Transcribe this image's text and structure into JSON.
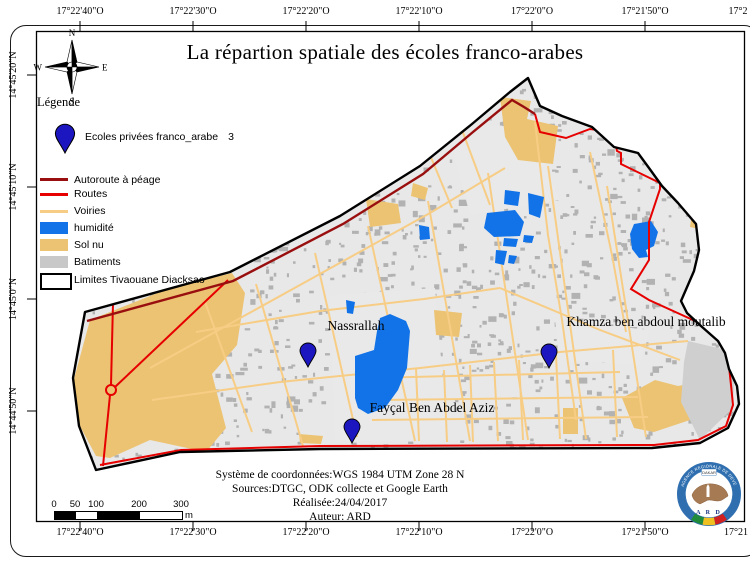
{
  "title": "La répartion spatiale des écoles franco-arabes",
  "compass": {
    "n": "N",
    "e": "E",
    "s": "S",
    "w": "W"
  },
  "legend": {
    "heading": "Légende",
    "schools": {
      "label": "Ecoles privées franco_arabe",
      "count": "3"
    },
    "items": [
      {
        "label": "Autoroute à péage",
        "swatch": "line",
        "color": "#990f0f",
        "y": 178,
        "h": 3
      },
      {
        "label": "Routes",
        "swatch": "line",
        "color": "#e60000",
        "y": 193,
        "h": 2.5
      },
      {
        "label": "Voiries",
        "swatch": "line",
        "color": "#f7cd85",
        "y": 210,
        "h": 2.5
      },
      {
        "label": "humidité",
        "swatch": "rect",
        "color": "#1273e8",
        "y": 222,
        "h": 12
      },
      {
        "label": "Sol nu",
        "swatch": "rect",
        "color": "#ecc372",
        "y": 239,
        "h": 12
      },
      {
        "label": "Batiments",
        "swatch": "rect",
        "color": "#c8c8c8",
        "y": 256,
        "h": 12
      },
      {
        "label": "Limites Tivaouane Diacksao",
        "swatch": "outline",
        "color": "#ffffff",
        "y": 273,
        "h": 13
      }
    ]
  },
  "graticule": {
    "top": [
      {
        "text": "17°22'40\"O",
        "x": 80
      },
      {
        "text": "17°22'30\"O",
        "x": 193
      },
      {
        "text": "17°22'20\"O",
        "x": 306
      },
      {
        "text": "17°22'10\"O",
        "x": 419
      },
      {
        "text": "17°22'0\"O",
        "x": 532
      },
      {
        "text": "17°21'50\"O",
        "x": 645
      },
      {
        "text": "17°2",
        "x": 738,
        "partial": true
      }
    ],
    "bottom": [
      {
        "text": "17°22'40\"O",
        "x": 80
      },
      {
        "text": "17°22'30\"O",
        "x": 193
      },
      {
        "text": "17°22'20\"O",
        "x": 306
      },
      {
        "text": "17°22'10\"O",
        "x": 419
      },
      {
        "text": "17°22'0\"O",
        "x": 532
      },
      {
        "text": "17°21'50\"O",
        "x": 645
      },
      {
        "text": "17°21",
        "x": 736,
        "partial": true
      }
    ],
    "left": [
      {
        "text": "14°45'20\"N",
        "y": 75
      },
      {
        "text": "14°45'10\"N",
        "y": 187
      },
      {
        "text": "14°45'0\"N",
        "y": 299
      },
      {
        "text": "14°44'50\"N",
        "y": 411
      }
    ]
  },
  "map_labels": [
    {
      "text": "Nassrallah",
      "x": 356,
      "y": 330
    },
    {
      "text": "Fayçal Ben Abdel Aziz",
      "x": 432,
      "y": 412
    },
    {
      "text": "Khamza ben abdoul moutalib",
      "x": 646,
      "y": 326
    }
  ],
  "credits": [
    "Système de coordonnées:WGS 1984 UTM Zone 28 N",
    "Sources:DTGC, ODK collecte et Google Earth",
    "Réalisée:24/04/2017",
    "Auteur: ARD"
  ],
  "scalebar": {
    "labels": [
      {
        "t": "0",
        "o": 0
      },
      {
        "t": "50",
        "o": 21
      },
      {
        "t": "100",
        "o": 42
      },
      {
        "t": "200",
        "o": 85
      },
      {
        "t": "300",
        "o": 127
      }
    ],
    "segments": [
      {
        "o": 0,
        "w": 21,
        "c": "#000000"
      },
      {
        "o": 21,
        "w": 21,
        "c": "#ffffff"
      },
      {
        "o": 42,
        "w": 43,
        "c": "#000000"
      },
      {
        "o": 85,
        "w": 42,
        "c": "#ffffff"
      }
    ],
    "unit": "m"
  },
  "logo": {
    "ring_text": "AGENCE REGIONALE DE DEVELOPPEMENT",
    "banner": "DAKAR",
    "name": "A R D"
  },
  "colors": {
    "district_bg": "#e8e8e8",
    "building": "#b2b2b2",
    "clearing": "#e9e9e9",
    "sol_nu": "#ecc372",
    "voirie": "#f7cd85",
    "humidite": "#1273e8",
    "autoroute": "#990f0f",
    "route": "#e60000",
    "boundary": "#000000",
    "pin": "#1c16c0",
    "batiment_zone": "#cfcfcf"
  },
  "map": {
    "boundary": [
      [
        85,
        312
      ],
      [
        230,
        272
      ],
      [
        340,
        216
      ],
      [
        420,
        166
      ],
      [
        472,
        124
      ],
      [
        510,
        92
      ],
      [
        528,
        78
      ],
      [
        540,
        106
      ],
      [
        562,
        116
      ],
      [
        592,
        127
      ],
      [
        614,
        147
      ],
      [
        638,
        153
      ],
      [
        649,
        168
      ],
      [
        662,
        186
      ],
      [
        678,
        203
      ],
      [
        696,
        224
      ],
      [
        699,
        250
      ],
      [
        694,
        271
      ],
      [
        681,
        301
      ],
      [
        687,
        313
      ],
      [
        701,
        326
      ],
      [
        718,
        341
      ],
      [
        725,
        353
      ],
      [
        729,
        369
      ],
      [
        737,
        386
      ],
      [
        739,
        404
      ],
      [
        728,
        428
      ],
      [
        700,
        443
      ],
      [
        652,
        448
      ],
      [
        320,
        449
      ],
      [
        180,
        452
      ],
      [
        96,
        470
      ],
      [
        79,
        426
      ],
      [
        73,
        378
      ]
    ],
    "autoroute": [
      [
        87,
        321
      ],
      [
        233,
        281
      ],
      [
        343,
        224
      ],
      [
        423,
        174
      ],
      [
        473,
        132
      ],
      [
        512,
        100
      ],
      [
        524,
        107
      ],
      [
        535,
        114
      ]
    ],
    "routes": [
      [
        [
          535,
          114
        ],
        [
          540,
          132
        ],
        [
          566,
          138
        ],
        [
          590,
          129
        ],
        [
          613,
          132
        ],
        [
          617,
          151
        ],
        [
          621,
          153
        ],
        [
          621,
          164
        ],
        [
          660,
          183
        ],
        [
          660,
          189
        ],
        [
          649,
          222
        ],
        [
          649,
          260
        ],
        [
          631,
          289
        ],
        [
          649,
          300
        ],
        [
          715,
          330
        ],
        [
          722,
          342
        ],
        [
          728,
          357
        ],
        [
          731,
          385
        ],
        [
          733,
          405
        ],
        [
          726,
          426
        ],
        [
          698,
          440
        ],
        [
          654,
          445
        ],
        [
          320,
          446
        ],
        [
          181,
          450
        ],
        [
          100,
          465
        ]
      ],
      [
        [
          113,
          303
        ],
        [
          111,
          385
        ]
      ],
      [
        [
          110,
          395
        ],
        [
          103,
          466
        ]
      ],
      [
        [
          115,
          387
        ],
        [
          228,
          280
        ]
      ]
    ],
    "roundabout": {
      "cx": 111,
      "cy": 390,
      "r": 5
    },
    "clearings": [
      [
        [
          330,
          295
        ],
        [
          435,
          288
        ],
        [
          448,
          440
        ],
        [
          335,
          442
        ]
      ],
      [
        [
          445,
          120
        ],
        [
          530,
          130
        ],
        [
          560,
          200
        ],
        [
          470,
          215
        ]
      ],
      [
        [
          555,
          320
        ],
        [
          650,
          330
        ],
        [
          640,
          365
        ],
        [
          560,
          360
        ]
      ]
    ],
    "sol_nu": [
      [
        [
          90,
          320
        ],
        [
          165,
          290
        ],
        [
          232,
          273
        ],
        [
          245,
          293
        ],
        [
          237,
          345
        ],
        [
          212,
          374
        ],
        [
          226,
          428
        ],
        [
          206,
          452
        ],
        [
          150,
          440
        ],
        [
          110,
          458
        ],
        [
          96,
          456
        ],
        [
          80,
          426
        ],
        [
          74,
          379
        ]
      ],
      [
        [
          366,
          199
        ],
        [
          398,
          204
        ],
        [
          401,
          223
        ],
        [
          370,
          227
        ]
      ],
      [
        [
          500,
          97
        ],
        [
          531,
          101
        ],
        [
          527,
          119
        ],
        [
          558,
          126
        ],
        [
          553,
          164
        ],
        [
          518,
          160
        ],
        [
          505,
          137
        ]
      ],
      [
        [
          434,
          310
        ],
        [
          462,
          313
        ],
        [
          459,
          337
        ],
        [
          436,
          335
        ]
      ],
      [
        [
          299,
          434
        ],
        [
          323,
          436
        ],
        [
          321,
          444
        ],
        [
          300,
          443
        ]
      ],
      [
        [
          622,
          398
        ],
        [
          655,
          380
        ],
        [
          678,
          386
        ],
        [
          694,
          383
        ],
        [
          690,
          420
        ],
        [
          654,
          432
        ],
        [
          634,
          428
        ]
      ],
      [
        [
          563,
          408
        ],
        [
          578,
          408
        ],
        [
          578,
          434
        ],
        [
          563,
          434
        ]
      ],
      [
        [
          692,
          212
        ],
        [
          713,
          219
        ],
        [
          709,
          231
        ],
        [
          690,
          227
        ]
      ],
      [
        [
          413,
          183
        ],
        [
          428,
          188
        ],
        [
          425,
          200
        ],
        [
          411,
          196
        ]
      ]
    ],
    "batiments_zones": [
      [
        [
          688,
          341
        ],
        [
          735,
          352
        ],
        [
          733,
          408
        ],
        [
          700,
          440
        ],
        [
          681,
          402
        ],
        [
          684,
          362
        ]
      ]
    ],
    "voiries": [
      [
        [
          150,
          368
        ],
        [
          300,
          285
        ],
        [
          430,
          213
        ],
        [
          505,
          168
        ]
      ],
      [
        [
          205,
          302
        ],
        [
          252,
          432
        ]
      ],
      [
        [
          256,
          284
        ],
        [
          303,
          446
        ]
      ],
      [
        [
          315,
          253
        ],
        [
          357,
          437
        ]
      ],
      [
        [
          368,
          226
        ],
        [
          415,
          441
        ]
      ],
      [
        [
          428,
          201
        ],
        [
          470,
          441
        ]
      ],
      [
        [
          488,
          173
        ],
        [
          528,
          440
        ]
      ],
      [
        [
          548,
          166
        ],
        [
          586,
          439
        ]
      ],
      [
        [
          607,
          186
        ],
        [
          646,
          437
        ]
      ],
      [
        [
          535,
          122
        ],
        [
          548,
          235
        ],
        [
          562,
          320
        ],
        [
          576,
          420
        ]
      ],
      [
        [
          590,
          152
        ],
        [
          612,
          255
        ],
        [
          626,
          332
        ]
      ],
      [
        [
          152,
          400
        ],
        [
          280,
          382
        ],
        [
          420,
          368
        ],
        [
          560,
          352
        ],
        [
          688,
          341
        ]
      ],
      [
        [
          196,
          332
        ],
        [
          320,
          311
        ],
        [
          424,
          299
        ],
        [
          500,
          288
        ]
      ],
      [
        [
          500,
          288
        ],
        [
          600,
          330
        ],
        [
          680,
          360
        ]
      ],
      [
        [
          370,
          378
        ],
        [
          620,
          372
        ]
      ],
      [
        [
          378,
          400
        ],
        [
          638,
          397
        ]
      ],
      [
        [
          372,
          420
        ],
        [
          648,
          417
        ]
      ],
      [
        [
          416,
          368
        ],
        [
          419,
          441
        ]
      ],
      [
        [
          444,
          370
        ],
        [
          447,
          442
        ]
      ],
      [
        [
          470,
          365
        ],
        [
          473,
          442
        ]
      ],
      [
        [
          494,
          362
        ],
        [
          498,
          441
        ]
      ],
      [
        [
          519,
          360
        ],
        [
          523,
          440
        ]
      ],
      [
        [
          556,
          355
        ],
        [
          560,
          439
        ]
      ],
      [
        [
          613,
          350
        ],
        [
          617,
          437
        ]
      ],
      [
        [
          462,
          130
        ],
        [
          490,
          205
        ]
      ],
      [
        [
          430,
          155
        ],
        [
          452,
          208
        ]
      ]
    ],
    "humidite": [
      [
        [
          380,
          318
        ],
        [
          390,
          314
        ],
        [
          406,
          321
        ],
        [
          410,
          331
        ],
        [
          407,
          368
        ],
        [
          398,
          390
        ],
        [
          385,
          408
        ],
        [
          368,
          414
        ],
        [
          358,
          408
        ],
        [
          355,
          398
        ],
        [
          355,
          356
        ],
        [
          374,
          350
        ],
        [
          377,
          331
        ]
      ],
      [
        [
          505,
          190
        ],
        [
          520,
          192
        ],
        [
          518,
          206
        ],
        [
          504,
          204
        ]
      ],
      [
        [
          528,
          193
        ],
        [
          544,
          197
        ],
        [
          540,
          218
        ],
        [
          529,
          214
        ]
      ],
      [
        [
          487,
          213
        ],
        [
          515,
          210
        ],
        [
          524,
          222
        ],
        [
          520,
          236
        ],
        [
          494,
          237
        ],
        [
          484,
          228
        ]
      ],
      [
        [
          504,
          238
        ],
        [
          518,
          239
        ],
        [
          516,
          247
        ],
        [
          503,
          246
        ]
      ],
      [
        [
          524,
          235
        ],
        [
          534,
          236
        ],
        [
          532,
          243
        ],
        [
          523,
          242
        ]
      ],
      [
        [
          496,
          250
        ],
        [
          507,
          251
        ],
        [
          504,
          265
        ],
        [
          495,
          263
        ]
      ],
      [
        [
          509,
          255
        ],
        [
          517,
          256
        ],
        [
          514,
          264
        ],
        [
          508,
          263
        ]
      ],
      [
        [
          634,
          224
        ],
        [
          651,
          221
        ],
        [
          658,
          232
        ],
        [
          654,
          246
        ],
        [
          646,
          250
        ],
        [
          648,
          257
        ],
        [
          639,
          258
        ],
        [
          632,
          249
        ],
        [
          630,
          234
        ]
      ],
      [
        [
          419,
          225
        ],
        [
          429,
          227
        ],
        [
          430,
          239
        ],
        [
          420,
          240
        ]
      ],
      [
        [
          346,
          300
        ],
        [
          355,
          302
        ],
        [
          353,
          314
        ],
        [
          347,
          313
        ]
      ]
    ],
    "pins": [
      {
        "x": 308,
        "y": 367,
        "s": 1
      },
      {
        "x": 352,
        "y": 443,
        "s": 1
      },
      {
        "x": 549,
        "y": 368,
        "s": 1
      }
    ],
    "legend_pin": {
      "x": 65,
      "y": 153,
      "s": 1.2
    }
  }
}
